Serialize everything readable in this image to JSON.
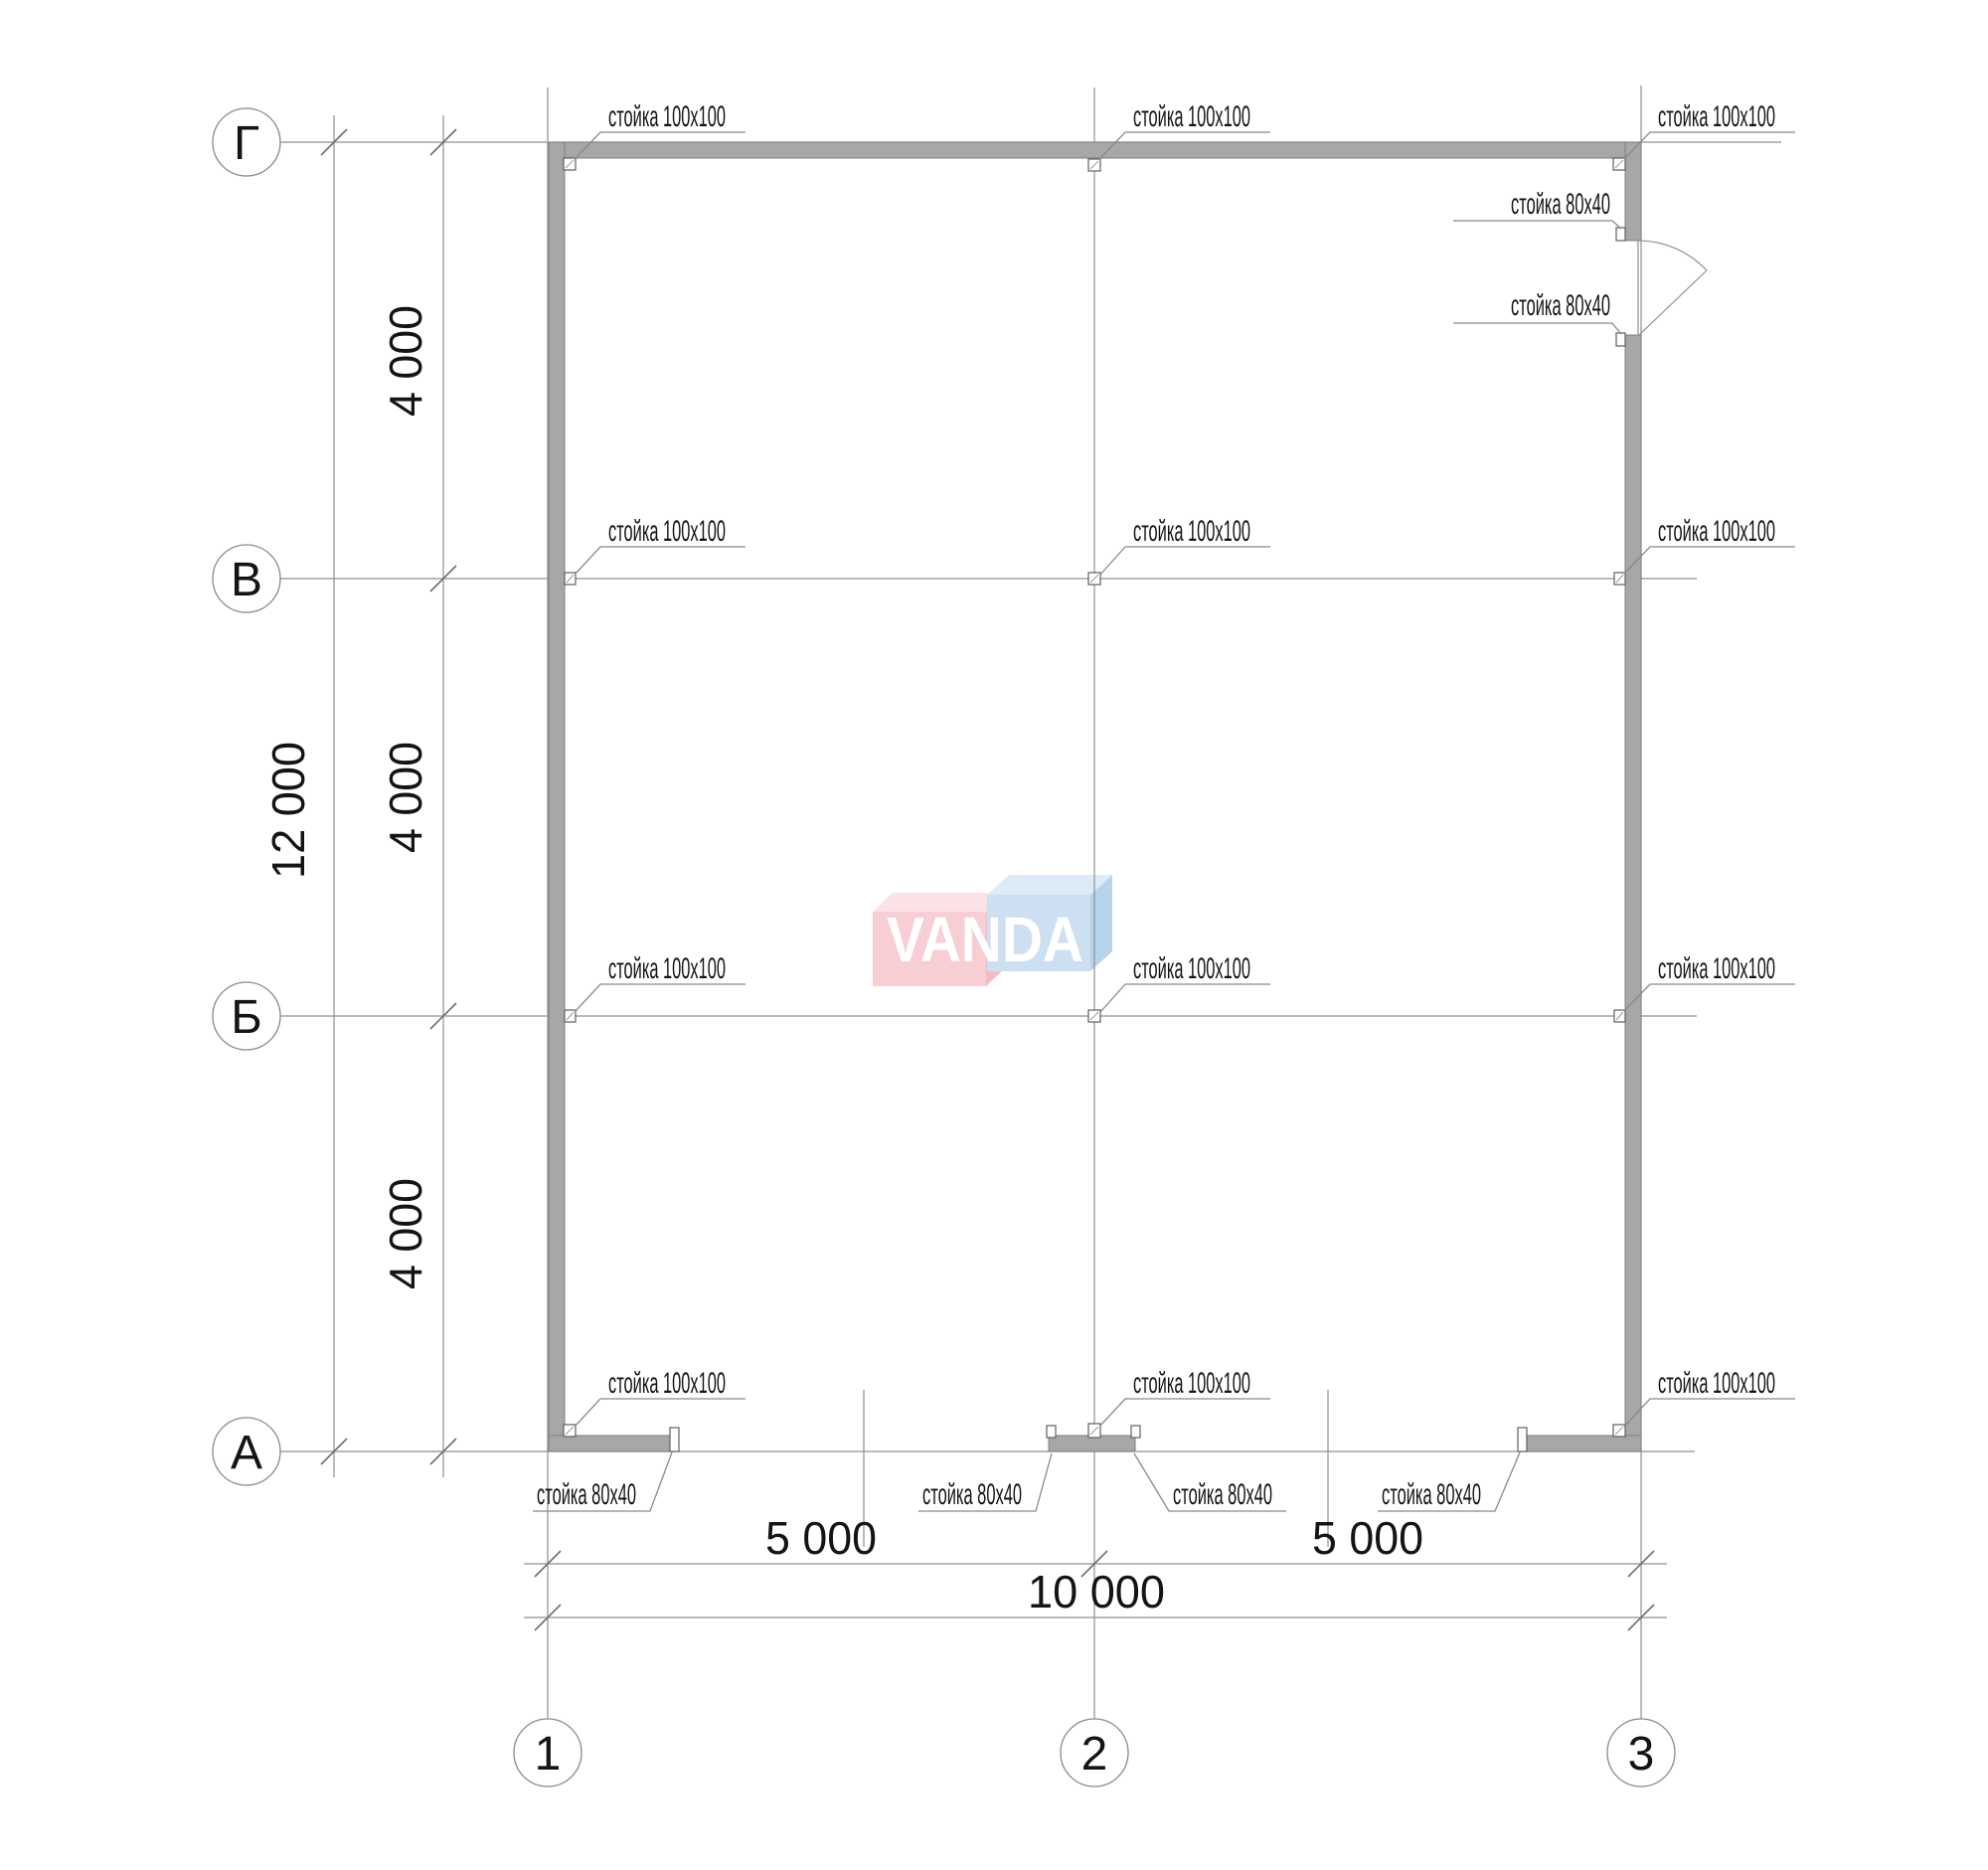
{
  "page": {
    "background": "#ffffff"
  },
  "axes": {
    "rows": [
      {
        "label": "Г"
      },
      {
        "label": "В"
      },
      {
        "label": "Б"
      },
      {
        "label": "А"
      }
    ],
    "cols": [
      {
        "label": "1"
      },
      {
        "label": "2"
      },
      {
        "label": "3"
      }
    ]
  },
  "dimensions": {
    "bay_width": "5 000",
    "total_width": "10 000",
    "bay_height": "4 000",
    "total_height": "12 000"
  },
  "annotations": {
    "post_100": "стойка 100x100",
    "post_80": "стойка 80x40"
  },
  "watermark": {
    "text": "VANDA",
    "pink_front": "#f7ced3",
    "pink_top": "#fbe2e6",
    "pink_side": "#f2bcc5",
    "blue_front": "#cde0f2",
    "blue_top": "#ddebf8",
    "blue_side": "#b8d4eb",
    "text_color": "#ffffff"
  },
  "colors": {
    "wall_fill": "#a7a7a7",
    "wall_stroke": "#7f7f7f",
    "line": "#8f8f8f",
    "text": "#141414"
  }
}
